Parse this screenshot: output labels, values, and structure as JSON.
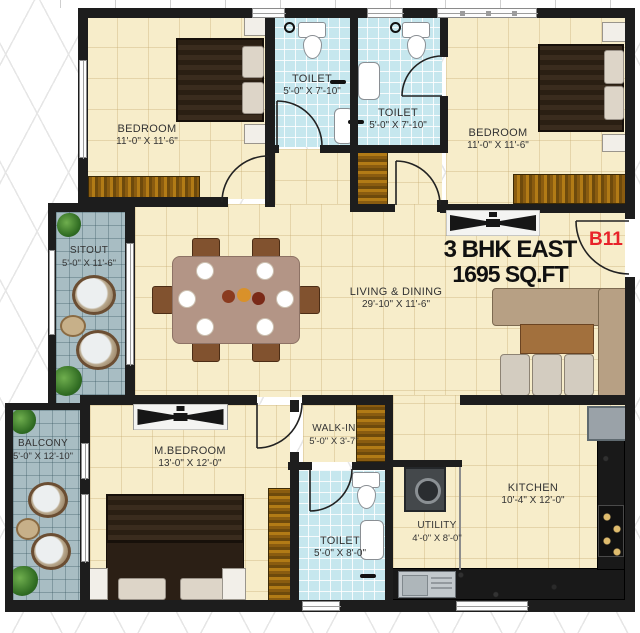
{
  "plan": {
    "header": {
      "line1": "3 BHK EAST",
      "line2": "1695 SQ.FT",
      "unit": "B11"
    },
    "rooms": {
      "bedroom_tl": {
        "name": "BEDROOM",
        "dims": "11'-0\" X 11'-6\""
      },
      "toilet_t1": {
        "name": "TOILET",
        "dims": "5'-0\" X 7'-10\""
      },
      "toilet_t2": {
        "name": "TOILET",
        "dims": "5'-0\" X 7'-10\""
      },
      "bedroom_tr": {
        "name": "BEDROOM",
        "dims": "11'-0\" X 11'-6\""
      },
      "sitout": {
        "name": "SITOUT",
        "dims": "5'-0\" X 11'-6\""
      },
      "living": {
        "name": "LIVING & DINING",
        "dims": "29'-10\" X 11'-6\""
      },
      "balcony": {
        "name": "BALCONY",
        "dims": "5'-0\" X 12'-10\""
      },
      "master_bedroom": {
        "name": "M.BEDROOM",
        "dims": "13'-0\" X 12'-0\""
      },
      "walk_in": {
        "name": "WALK-IN",
        "dims": "5'-0\" X 3'-7\""
      },
      "toilet_b": {
        "name": "TOILET",
        "dims": "5'-0\" X 8'-0\""
      },
      "utility": {
        "name": "UTILITY",
        "dims": "4'-0\" X 8'-0\""
      },
      "kitchen": {
        "name": "KITCHEN",
        "dims": "10'-4\" X 12'-0\""
      }
    },
    "colors": {
      "accent_red": "#E8232A",
      "wall": "#1D1D1D",
      "floor_cream": "#F7EDCA",
      "floor_tile_blue": "#C6E7EE",
      "floor_deck": "#A8BDC3",
      "wood": "#A9761A",
      "counter_dark": "#191919"
    }
  }
}
